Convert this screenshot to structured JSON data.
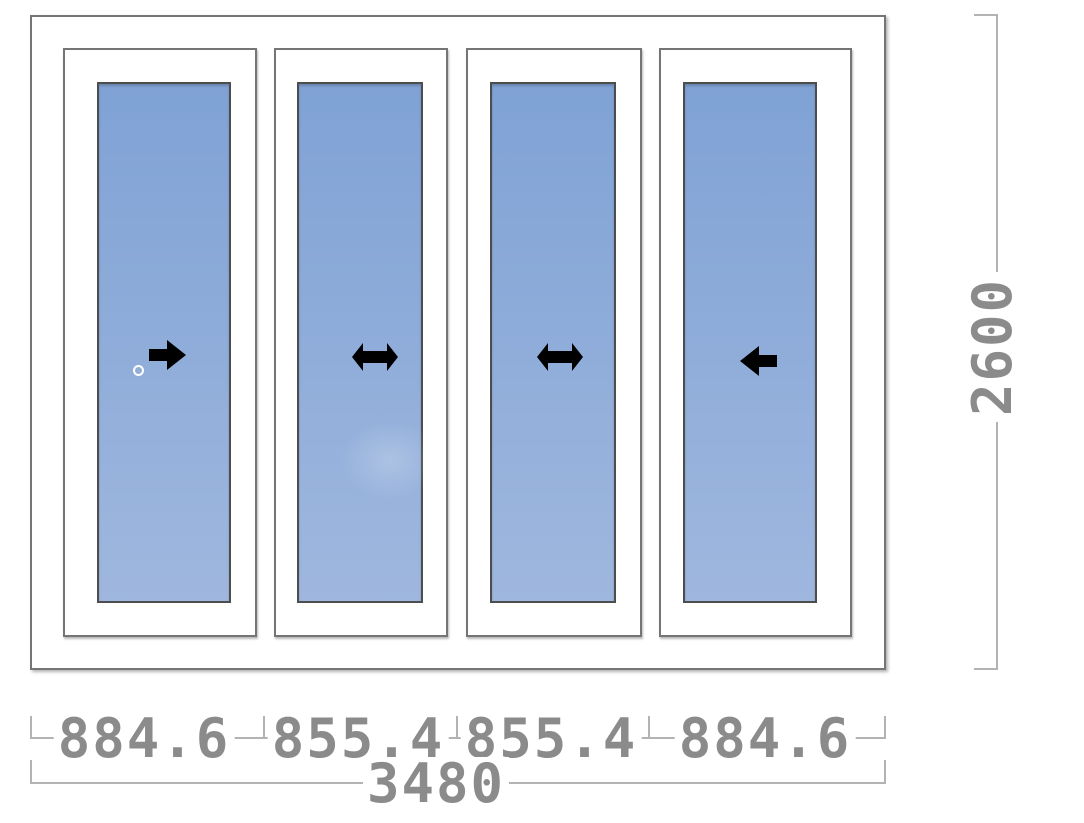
{
  "diagram": {
    "kind": "sliding-window-elevation",
    "leaf_count": 4,
    "panels": [
      {
        "width_label": "884.6",
        "movement": "slides-right",
        "icon": "arrow-right-icon",
        "has_handle": true
      },
      {
        "width_label": "855.4",
        "movement": "slides-both",
        "icon": "arrow-left-right-icon",
        "has_handle": false
      },
      {
        "width_label": "855.4",
        "movement": "slides-both",
        "icon": "arrow-left-right-icon",
        "has_handle": false
      },
      {
        "width_label": "884.6",
        "movement": "slides-left",
        "icon": "arrow-left-icon",
        "has_handle": false
      }
    ],
    "dimensions": {
      "panel_widths": [
        "884.6",
        "855.4",
        "855.4",
        "884.6"
      ],
      "total_width": "3480",
      "height": "2600"
    },
    "colors": {
      "glass-top": "#7fa2d5",
      "glass-bottom": "#9fb7de",
      "frame-border": "#757575",
      "glass-border": "#4d4d4d",
      "dim-text": "#8b8b8b",
      "dim-line": "#b3b3b3",
      "arrow": "#000000",
      "handle": "#ffffff"
    }
  }
}
